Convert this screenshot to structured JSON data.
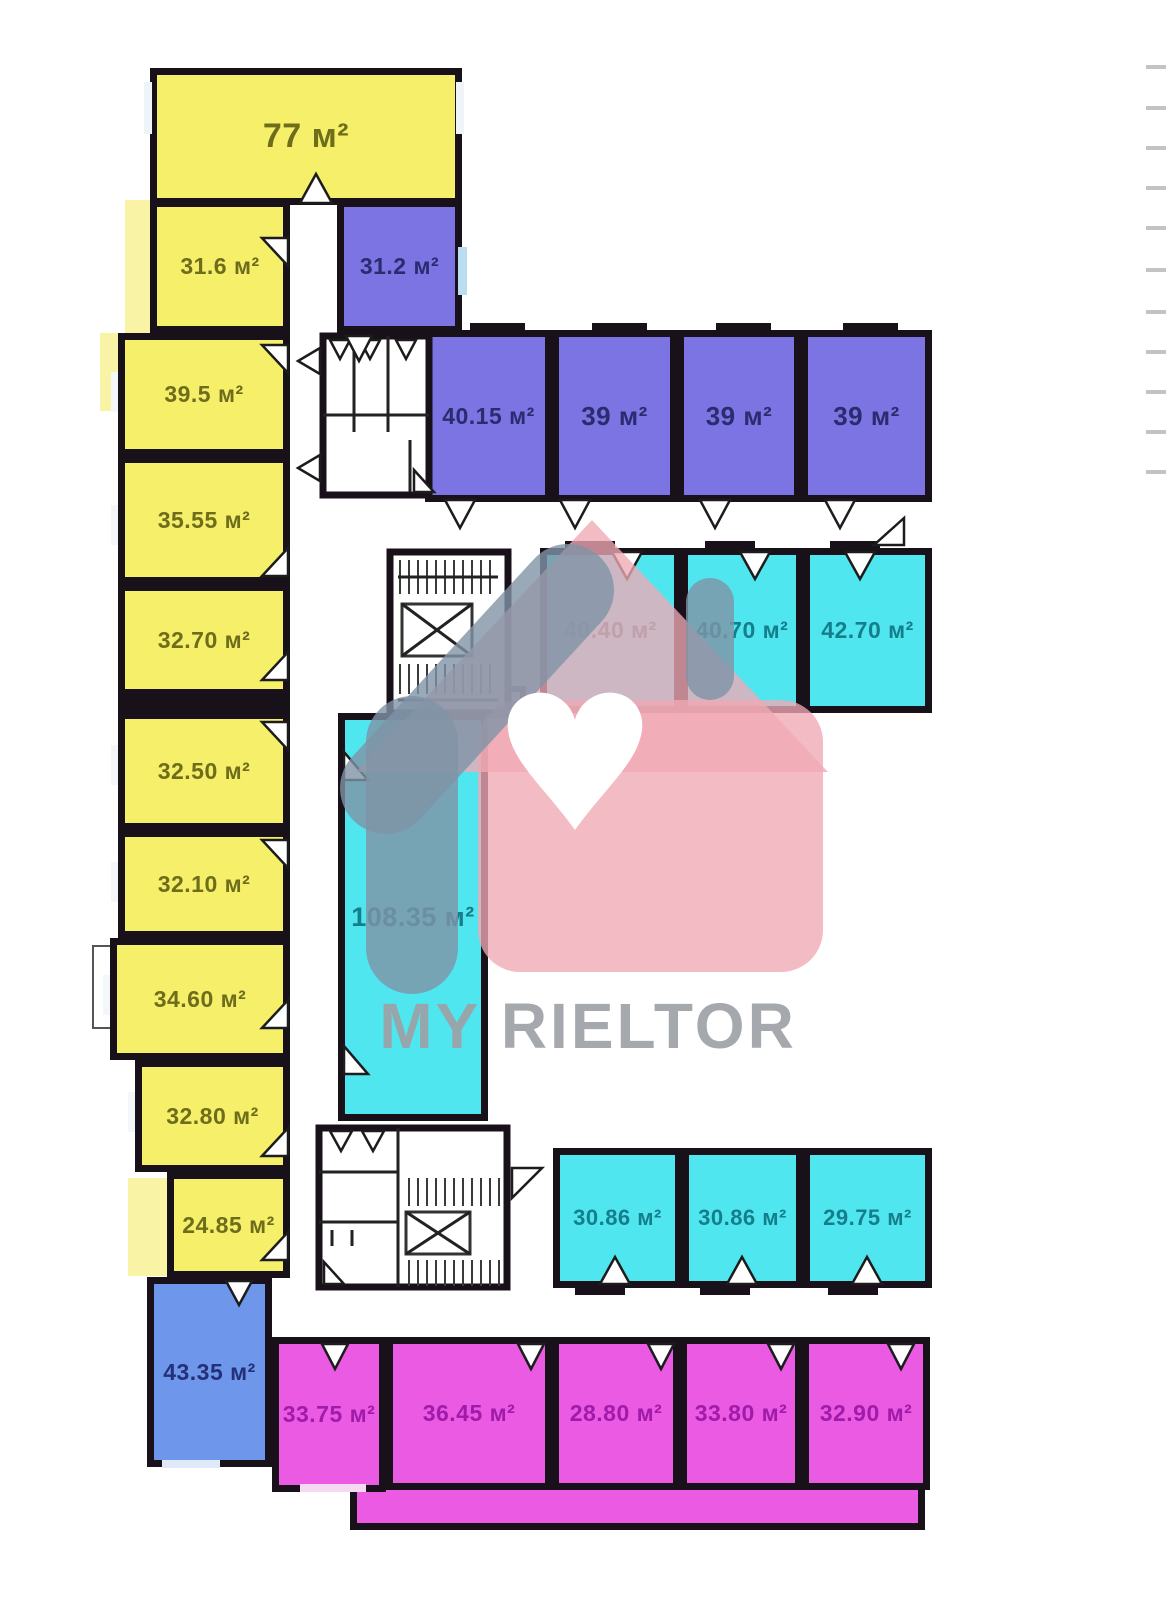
{
  "watermark": {
    "brand": "MY RIELTOR"
  },
  "area_unit": "м²",
  "rooms": [
    {
      "name": "room-77",
      "label": "77 м²",
      "group": "yellow"
    },
    {
      "name": "room-31-6",
      "label": "31.6 м²",
      "group": "yellow"
    },
    {
      "name": "room-39-5",
      "label": "39.5 м²",
      "group": "yellow"
    },
    {
      "name": "room-35-55",
      "label": "35.55 м²",
      "group": "yellow"
    },
    {
      "name": "room-32-70",
      "label": "32.70 м²",
      "group": "yellow"
    },
    {
      "name": "room-32-50",
      "label": "32.50 м²",
      "group": "yellow"
    },
    {
      "name": "room-32-10",
      "label": "32.10 м²",
      "group": "yellow"
    },
    {
      "name": "room-34-60",
      "label": "34.60 м²",
      "group": "yellow"
    },
    {
      "name": "room-32-80",
      "label": "32.80 м²",
      "group": "yellow"
    },
    {
      "name": "room-24-85",
      "label": "24.85 м²",
      "group": "yellow"
    },
    {
      "name": "room-31-2",
      "label": "31.2 м²",
      "group": "violet"
    },
    {
      "name": "room-40-15",
      "label": "40.15 м²",
      "group": "violet"
    },
    {
      "name": "room-39-a",
      "label": "39 м²",
      "group": "violet"
    },
    {
      "name": "room-39-b",
      "label": "39 м²",
      "group": "violet"
    },
    {
      "name": "room-39-c",
      "label": "39 м²",
      "group": "violet"
    },
    {
      "name": "room-40-40",
      "label": "40.40 м²",
      "group": "cyan"
    },
    {
      "name": "room-40-70",
      "label": "40.70 м²",
      "group": "cyan"
    },
    {
      "name": "room-42-70",
      "label": "42.70 м²",
      "group": "cyan"
    },
    {
      "name": "room-108-35",
      "label": "108.35 м²",
      "group": "cyan"
    },
    {
      "name": "room-30-86-a",
      "label": "30.86 м²",
      "group": "cyan"
    },
    {
      "name": "room-30-86-b",
      "label": "30.86 м²",
      "group": "cyan"
    },
    {
      "name": "room-29-75",
      "label": "29.75 м²",
      "group": "cyan"
    },
    {
      "name": "room-43-35",
      "label": "43.35 м²",
      "group": "blue"
    },
    {
      "name": "room-33-75",
      "label": "33.75 м²",
      "group": "magenta"
    },
    {
      "name": "room-36-45",
      "label": "36.45 м²",
      "group": "magenta"
    },
    {
      "name": "room-28-80",
      "label": "28.80 м²",
      "group": "magenta"
    },
    {
      "name": "room-33-80",
      "label": "33.80 м²",
      "group": "magenta"
    },
    {
      "name": "room-32-90",
      "label": "32.90 м²",
      "group": "magenta"
    }
  ],
  "palette": {
    "yellow": "#f6ef69",
    "pale_yellow": "#f9f4a5",
    "violet": "#7b74e2",
    "cyan": "#4fe6ef",
    "blue": "#6e97ec",
    "magenta": "#ea5ae3",
    "wall": "#191119",
    "watermark_pink": "#f0a9b5",
    "watermark_gray": "#7f94a6",
    "watermark_text": "#9da1a5"
  }
}
